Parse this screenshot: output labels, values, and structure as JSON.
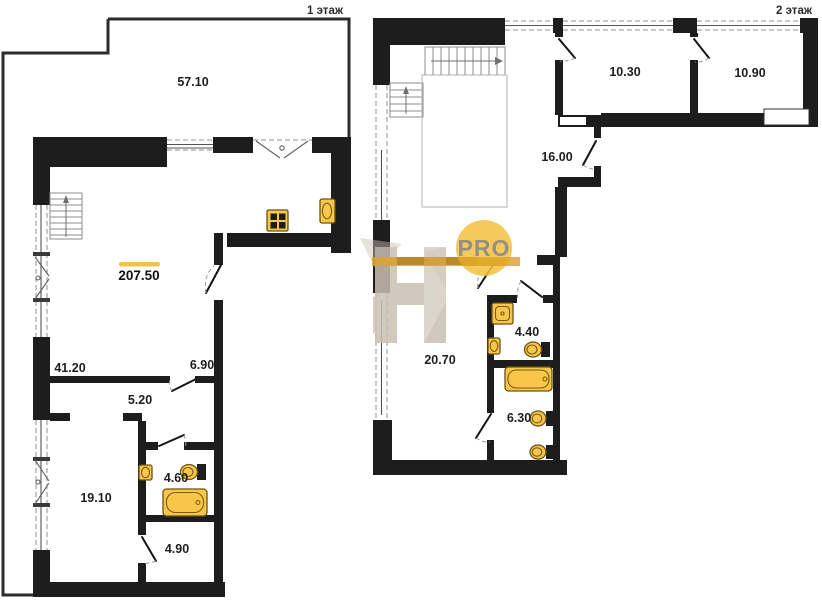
{
  "page": {
    "background": "#ffffff"
  },
  "floor1": {
    "title": "1 этаж",
    "total_area": "207.50",
    "rooms": {
      "terrace": "57.10",
      "living": "41.20",
      "entry": "6.90",
      "corridor": "5.20",
      "bedroom": "19.10",
      "bathroom": "4.60",
      "hallway": "4.90"
    }
  },
  "floor2": {
    "title": "2 этаж",
    "rooms": {
      "room_a": "10.30",
      "room_b": "10.90",
      "corridor": "16.00",
      "bedroom": "20.70",
      "bathroom_a": "4.40",
      "bathroom_b": "6.30"
    }
  },
  "watermark": {
    "brand": "PRO"
  },
  "colors": {
    "wall": "#1d1d1d",
    "fixture": "#f7c64a",
    "accent": "#f0c14e",
    "watermark_circle": "#f4c243",
    "watermark_band": "#dca428",
    "watermark_text": "#8a8a8a",
    "watermark_h": "#c9c0b3"
  }
}
